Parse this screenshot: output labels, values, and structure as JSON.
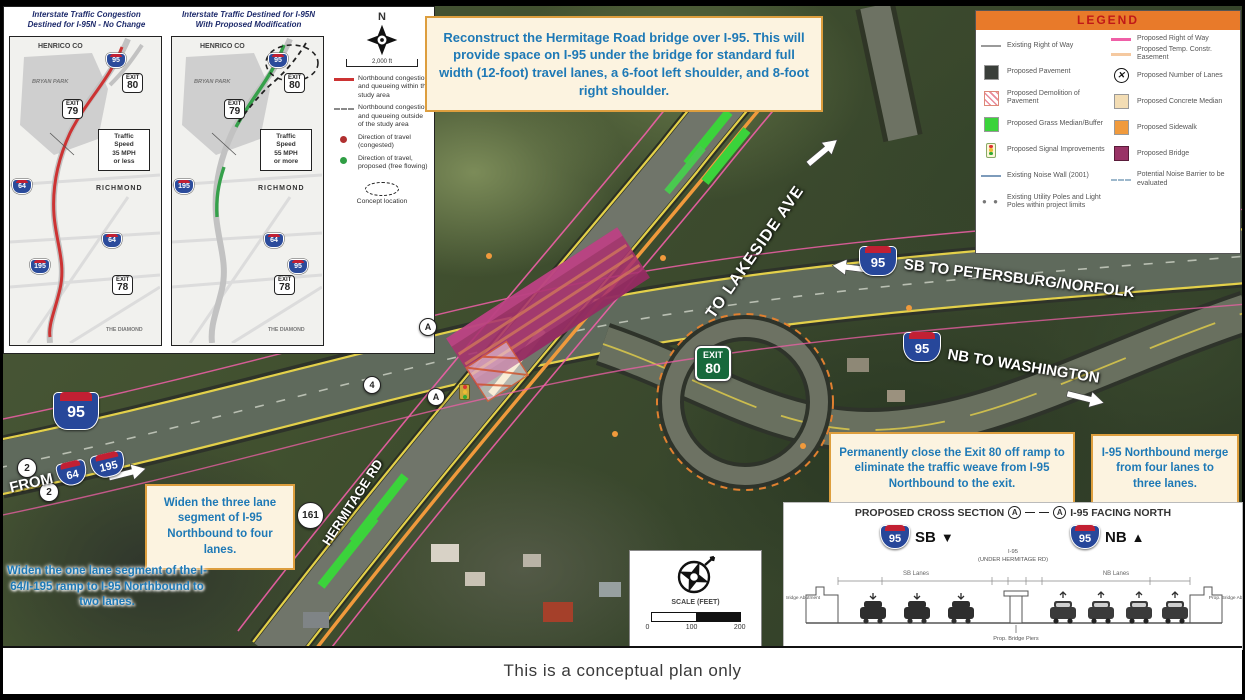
{
  "footer": "This is a conceptual plan only",
  "common": {
    "exit_word": "EXIT",
    "i95": "95",
    "i64": "64",
    "i195": "195"
  },
  "insets": {
    "left": {
      "title": "Interstate Traffic Congestion\nDestined for I-95N - No Change",
      "county": "HENRICO CO",
      "park": "BRYAN PARK",
      "city": "RICHMOND",
      "diamond": "THE DIAMOND",
      "exit_top": "80",
      "exit_mid": "79",
      "exit_low": "78",
      "speed_box": "Traffic\nSpeed\n35 MPH\nor less"
    },
    "right": {
      "title": "Interstate Traffic Destined for I-95N\nWith Proposed Modification",
      "county": "HENRICO CO",
      "park": "BRYAN PARK",
      "city": "RICHMOND",
      "diamond": "THE DIAMOND",
      "exit_top": "80",
      "exit_mid": "79",
      "exit_low": "78",
      "speed_box": "Traffic\nSpeed\n55 MPH\nor more"
    }
  },
  "mini_legend": {
    "north": "N",
    "scale": "2,000 ft",
    "items": [
      {
        "key": "red-line",
        "label": "Northbound congestion and queueing within the study area"
      },
      {
        "key": "dashed-line",
        "label": "Northbound congestion and queueing outside of the study area"
      },
      {
        "key": "red-dot",
        "label": "Direction of travel (congested)"
      },
      {
        "key": "green-dot",
        "label": "Direction of travel, proposed (free flowing)"
      },
      {
        "key": "concept-oval",
        "label": "Concept location"
      }
    ]
  },
  "legend": {
    "title": "LEGEND",
    "left": [
      {
        "swatch": "line-gray",
        "label": "Existing Right of Way"
      },
      {
        "swatch": "square-dark",
        "label": "Proposed Pavement"
      },
      {
        "swatch": "square-hatch",
        "label": "Proposed Demolition of Pavement"
      },
      {
        "swatch": "square-green",
        "label": "Proposed Grass Median/Buffer"
      },
      {
        "swatch": "signal",
        "label": "Proposed Signal Improvements"
      },
      {
        "swatch": "line-blue",
        "label": "Existing Noise Wall (2001)"
      },
      {
        "swatch": "dots",
        "label": "Existing Utility Poles and Light Poles within project limits"
      }
    ],
    "right": [
      {
        "swatch": "line-pink",
        "label": "Proposed Right of Way"
      },
      {
        "swatch": "line-peach",
        "label": "Proposed Temp. Constr. Easement"
      },
      {
        "swatch": "circle-x",
        "label": "Proposed Number of Lanes"
      },
      {
        "swatch": "square-beige",
        "label": "Proposed Concrete Median"
      },
      {
        "swatch": "square-orange",
        "label": "Proposed Sidewalk"
      },
      {
        "swatch": "square-maroon",
        "label": "Proposed Bridge"
      },
      {
        "swatch": "line-dashblue",
        "label": "Potential Noise Barrier to be evaluated"
      }
    ]
  },
  "callouts": {
    "bridge": "Reconstruct the Hermitage Road bridge over I-95. This will provide space on I-95 under the bridge for standard full width (12-foot) travel lanes, a 6-foot left shoulder, and 8-foot right shoulder.",
    "close_exit": "Permanently close the Exit 80 off ramp to eliminate the traffic weave from I-95 Northbound to the exit.",
    "merge": "I-95 Northbound merge from four lanes to three lanes.",
    "widen_three": "Widen the three lane segment of I-95 Northbound to four lanes.",
    "widen_one": "Widen the one lane segment of the I-64/I-195 ramp to I-95 Northbound to two lanes."
  },
  "map_labels": {
    "lakeside": "TO LAKESIDE AVE",
    "sb": "SB TO PETERSBURG/NORFOLK",
    "nb": "NB TO WASHINGTON",
    "from": "FROM",
    "hermitage": "HERMITAGE RD",
    "route161": "161",
    "exit_num": "80",
    "marker_a": "A",
    "marker_4": "4",
    "marker_2": "2"
  },
  "cross_section": {
    "title": "PROPOSED CROSS SECTION",
    "title_suffix": "I-95 FACING NORTH",
    "marker": "A",
    "sb": "SB",
    "nb": "NB",
    "sb_arrow": "▼",
    "nb_arrow": "▲",
    "subtitle": "I-95\n(UNDER HERMITAGE RD)",
    "sb_lanes": "SB Lanes",
    "nb_lanes": "NB Lanes",
    "left_abutment": "Prop. Bridge Abutment",
    "right_abutment": "Prop. Bridge Abutment",
    "piers": "Prop. Bridge Piers"
  },
  "scale_box": {
    "label": "SCALE (FEET)",
    "t0": "0",
    "t1": "100",
    "t2": "200"
  },
  "colors": {
    "callout_border": "#dd9e3e",
    "callout_text": "#1e79b6",
    "legend_header": "#e87a2a",
    "legend_title_text": "#c01818",
    "bridge": "#a8326e",
    "sidewalk": "#f09a3c",
    "grass": "#3bd33b",
    "concrete_median": "#f3ddb4",
    "row_pink": "#ef5fa7",
    "exit_green": "#17693c"
  }
}
